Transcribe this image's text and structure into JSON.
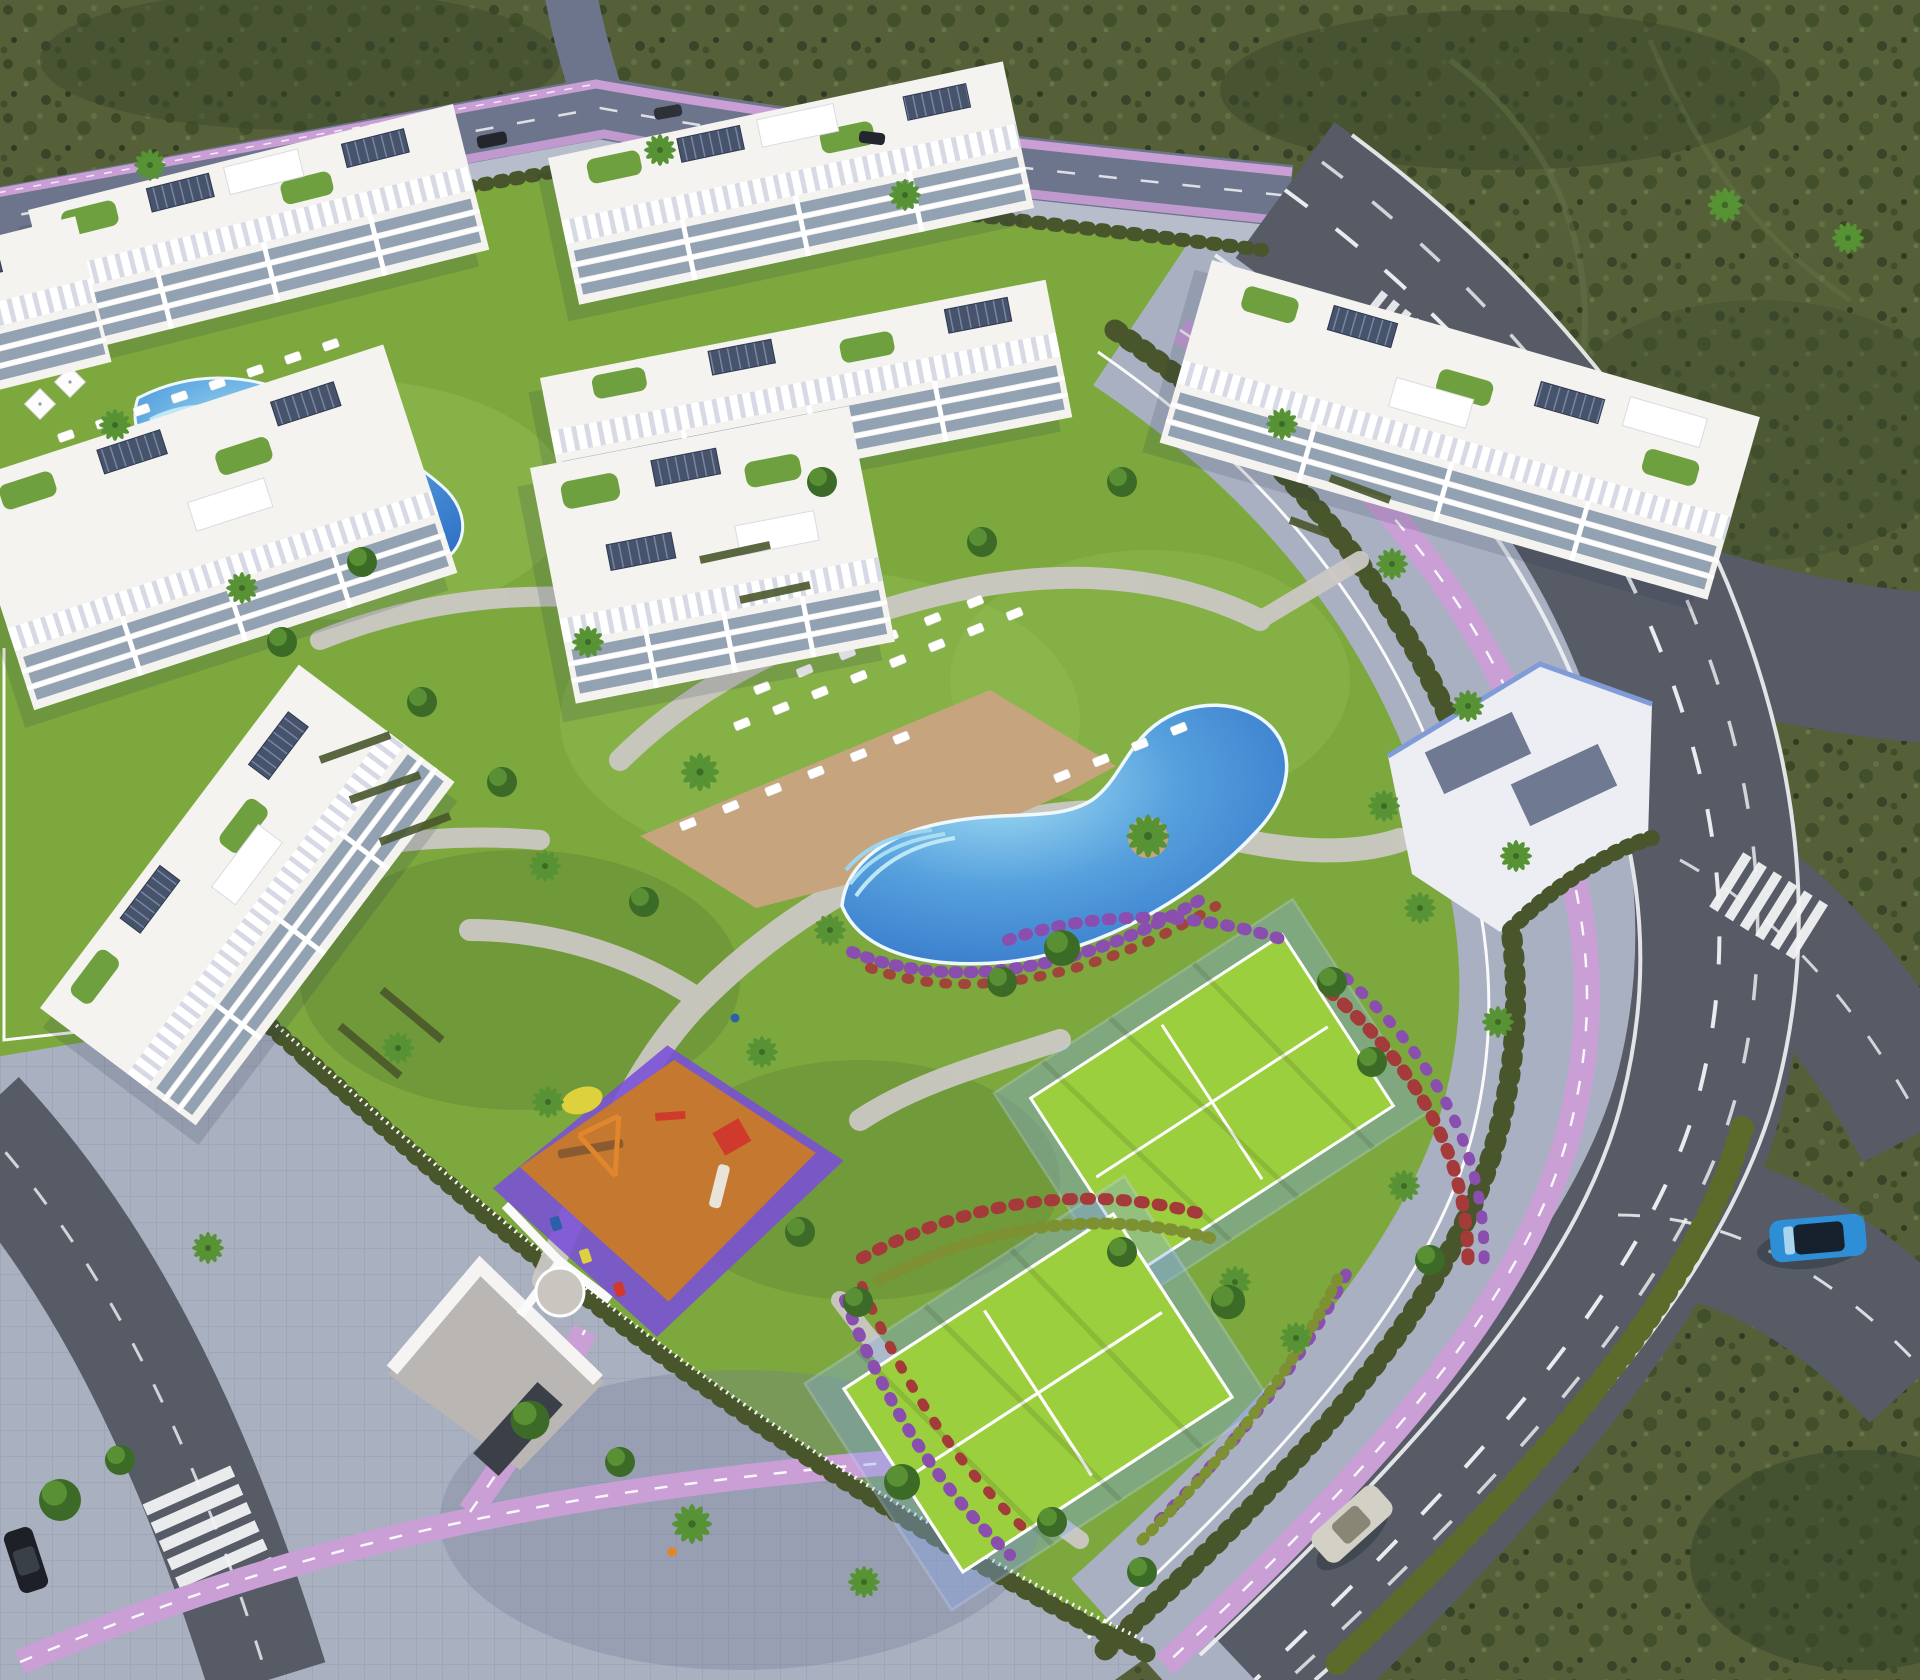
{
  "meta": {
    "description": "Aerial 3D architectural rendering of a gated white-apartment residential complex with lagoon pools, padel courts, playground, gardens and perimeter roads at late-afternoon light",
    "view": "high-angle aerial",
    "no_visible_text": true
  },
  "palette": {
    "scrub_base": "#556039",
    "scrub_dark": "#3b4827",
    "scrub_light": "#66764a",
    "grass": "#7ca83e",
    "grass_light": "#95bf54",
    "grass_shade": "#5e8233",
    "court_green": "#9ccf3d",
    "court_fence": "#86a9e6",
    "pool_deep": "#2d6cc4",
    "pool_mid": "#55a0dd",
    "pool_light": "#a6e0f5",
    "pool_rim": "#eef8fd",
    "deck_tan": "#c6a47e",
    "path_light": "#cbc8c4",
    "road_top": "#6d758c",
    "road_asphalt": "#565b66",
    "road_line": "#f2f3f5",
    "sidewalk": "#a9b0c2",
    "pavement": "#a9b0c0",
    "bike_pink": "#c99fd6",
    "hedge": "#49562b",
    "tree_dark": "#3c6b27",
    "tree_light": "#5f9637",
    "palm_green": "#579334",
    "flower_purple": "#8a4fae",
    "flower_red": "#a43a3a",
    "building_white": "#f4f3f0",
    "facade_glass": "#92a2b2",
    "solar_panel": "#46536b",
    "clubhouse_panel": "#6f7a92",
    "clubhouse_accent": "#7f9bd8",
    "playground_orange": "#c5782f",
    "playground_violet": "#7a4fd8",
    "equipment_red": "#d03a2c",
    "equipment_orange": "#e0862c",
    "umbrella_yellow": "#ddd23e",
    "car_blue": "#2f8fd6",
    "car_silver": "#d3d0c6",
    "car_dark": "#23262c"
  },
  "scene": {
    "buildings": {
      "count": 8,
      "style": "white modern blocks, rooftop pergola louvers, solar panels, terrace gardens"
    },
    "amenities": [
      "main-lagoon-pool",
      "sun-deck-with-loungers",
      "secondary-pool",
      "padel-court-upper",
      "padel-court-lower",
      "children-playground",
      "clubhouse",
      "entrance-gate",
      "garden-paths"
    ],
    "vehicles": [
      {
        "id": "blue-car",
        "location": "south-east curved road"
      },
      {
        "id": "silver-car",
        "location": "south boulevard"
      },
      {
        "id": "dark-car-top-1",
        "location": "north road"
      },
      {
        "id": "dark-car-top-2",
        "location": "north road"
      },
      {
        "id": "dark-car-crosswalk",
        "location": "south-west crossing"
      }
    ],
    "roads": {
      "lane_markings": "white dashes",
      "bike_lanes": "lavender pink with white dashes",
      "crossings": "zebra stripes"
    }
  }
}
